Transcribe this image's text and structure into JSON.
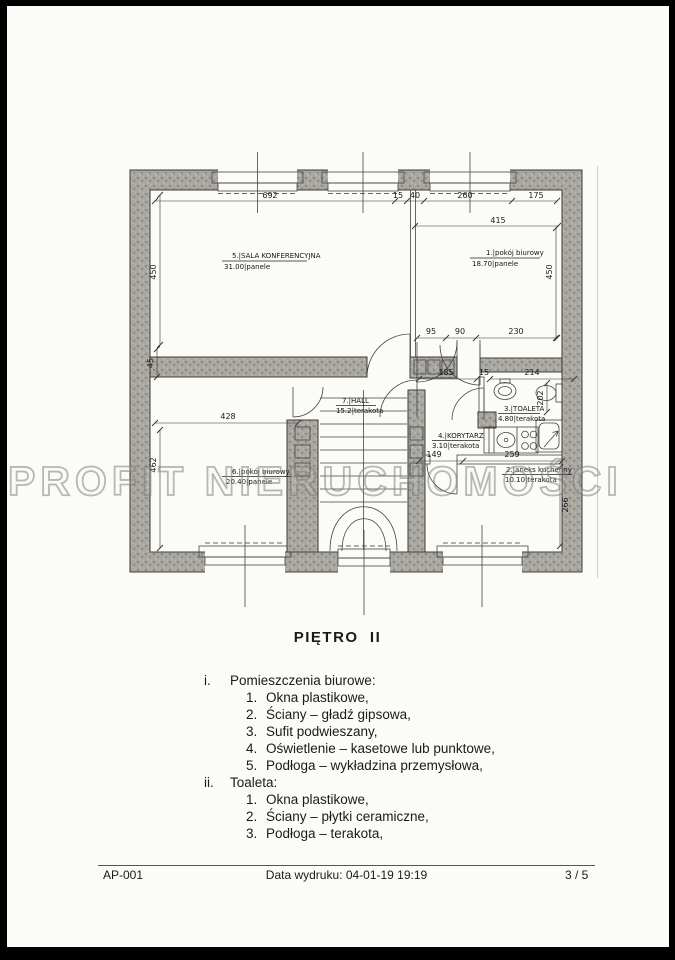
{
  "page": {
    "title": "PIĘTRO  II",
    "watermark": "PROFIT NIERUCHOMOŚCI"
  },
  "plan": {
    "rooms": {
      "sala": {
        "line1": "5.|SALA KONFERENCYJNA",
        "line2": "31.00|panele"
      },
      "biurowy1": {
        "line1": "1.|pokój biurowy",
        "line2": "18.70|panele"
      },
      "hall": {
        "line1": "7.|HALL",
        "line2": "15.2|terakota"
      },
      "toaleta": {
        "line1": "3.|TOALETA",
        "line2": "4.80|terakota"
      },
      "korytarz": {
        "line1": "4.|KORYTARZ",
        "line2": "3.10|terakota"
      },
      "biurowy6": {
        "line1": "6.|pokój biurowy",
        "line2": "20.40|panele"
      },
      "aneks": {
        "line1": "2.|aneks kuchenny",
        "line2": "10.10|terakota"
      }
    },
    "dims": {
      "top_692": "692",
      "top_15": "15",
      "top_40": "40",
      "top_260": "260",
      "top_175": "175",
      "right_415": "415",
      "left_450": "450",
      "right_450": "450",
      "mid_95": "95",
      "mid_90": "90",
      "mid_230": "230",
      "left_45": "45",
      "left_428": "428",
      "left_462": "462",
      "hall_185": "185",
      "hall_15": "15",
      "toaleta_214": "214",
      "toaleta_202": "202",
      "kor_149": "149",
      "kor_259": "259",
      "room2_266": "266"
    }
  },
  "notes": {
    "sections": [
      {
        "index": "i.",
        "title": "Pomieszczenia biurowe:",
        "items": [
          {
            "n": "1.",
            "t": "Okna plastikowe,"
          },
          {
            "n": "2.",
            "t": "Ściany – gładź gipsowa,"
          },
          {
            "n": "3.",
            "t": "Sufit podwieszany,"
          },
          {
            "n": "4.",
            "t": "Oświetlenie – kasetowe lub punktowe,"
          },
          {
            "n": "5.",
            "t": "Podłoga – wykładzina przemysłowa,"
          }
        ]
      },
      {
        "index": "ii.",
        "title": "Toaleta:",
        "items": [
          {
            "n": "1.",
            "t": "Okna plastikowe,"
          },
          {
            "n": "2.",
            "t": "Ściany – płytki ceramiczne,"
          },
          {
            "n": "3.",
            "t": "Podłoga – terakota,"
          }
        ]
      }
    ]
  },
  "footer": {
    "left": "AP-001",
    "center": "Data wydruku: 04-01-19 19:19",
    "right": "3 / 5"
  }
}
